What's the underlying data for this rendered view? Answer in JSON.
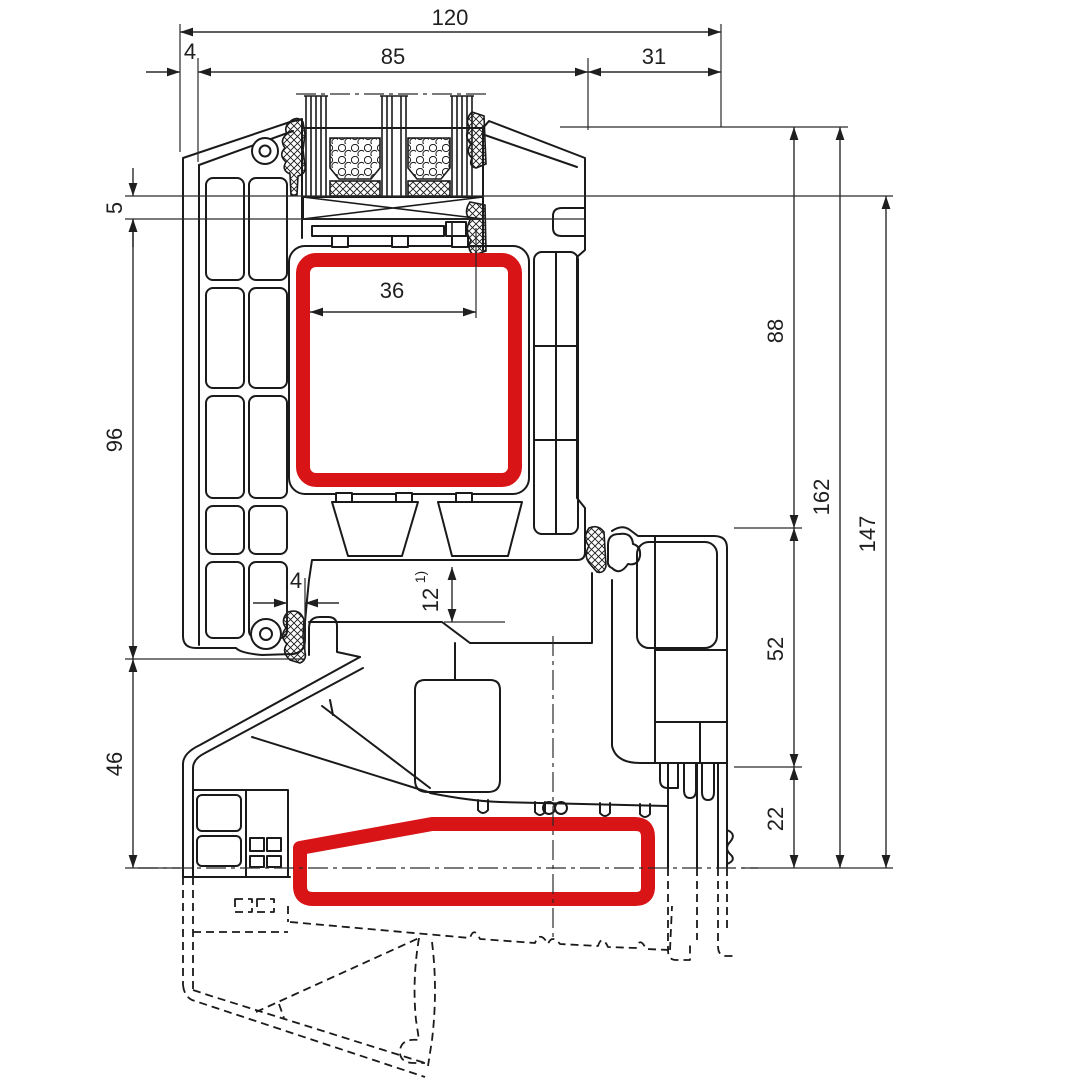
{
  "meta": {
    "title": "Window profile cross-section technical drawing"
  },
  "style": {
    "accent_red": "#d81417",
    "line_color": "#1a1a1a",
    "background": "#ffffff"
  },
  "dimensions": {
    "top_total": {
      "label": "120"
    },
    "top_sash": {
      "label": "85"
    },
    "top_frame": {
      "label": "31"
    },
    "top_offset": {
      "label": "4"
    },
    "left_seal": {
      "label": "5"
    },
    "left_sash": {
      "label": "96"
    },
    "left_sill": {
      "label": "46"
    },
    "mid_steel": {
      "label": "36"
    },
    "mid_gap": {
      "label": "4"
    },
    "mid_rebate": {
      "label": "12",
      "footnote": "1)"
    },
    "right_upper": {
      "label": "88"
    },
    "right_overall": {
      "label": "162"
    },
    "right_rebate": {
      "label": "147"
    },
    "right_lower": {
      "label": "52"
    },
    "right_step": {
      "label": "22"
    }
  }
}
